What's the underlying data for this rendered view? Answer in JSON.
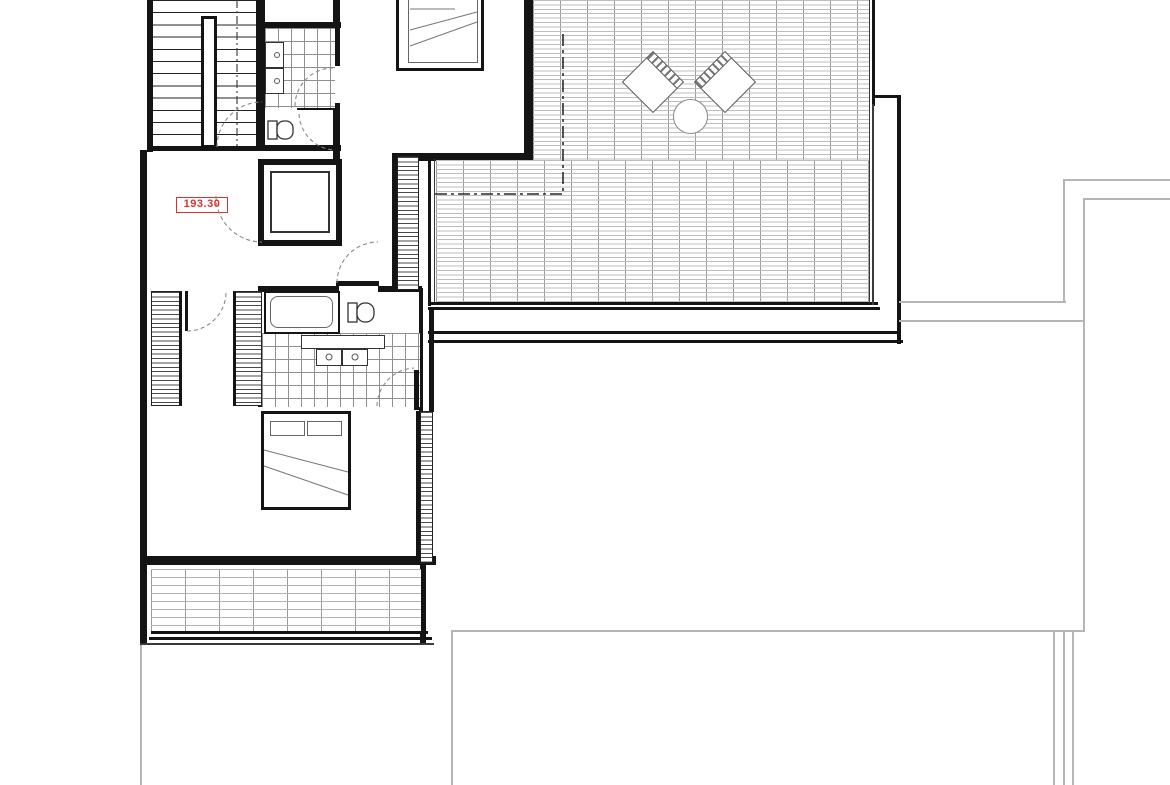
{
  "drawing": {
    "type": "architectural-floor-plan",
    "level_label": {
      "text": "193.30"
    },
    "colors": {
      "wall": "#141414",
      "annotation_red": "#d9332e",
      "tile_line": "#8f8f8f",
      "deck_line": "#9a9a9a",
      "site_outline_gray": "#b5b5b5",
      "background": "#ffffff"
    },
    "features": [
      "staircase",
      "stair-handrail",
      "elevator-shaft",
      "bathroom-top",
      "wc-top",
      "vanity-cabinets",
      "bedroom-top-bed",
      "corridor",
      "wardrobe-strips",
      "bathroom-middle",
      "bathtub",
      "double-sink-vanity",
      "toilet",
      "bedroom-bottom-bed",
      "balcony-deck",
      "roof-terrace-deck",
      "lounge-chairs",
      "round-table",
      "roof-overhang-dashdot-line",
      "lower-level-site-outline"
    ]
  }
}
